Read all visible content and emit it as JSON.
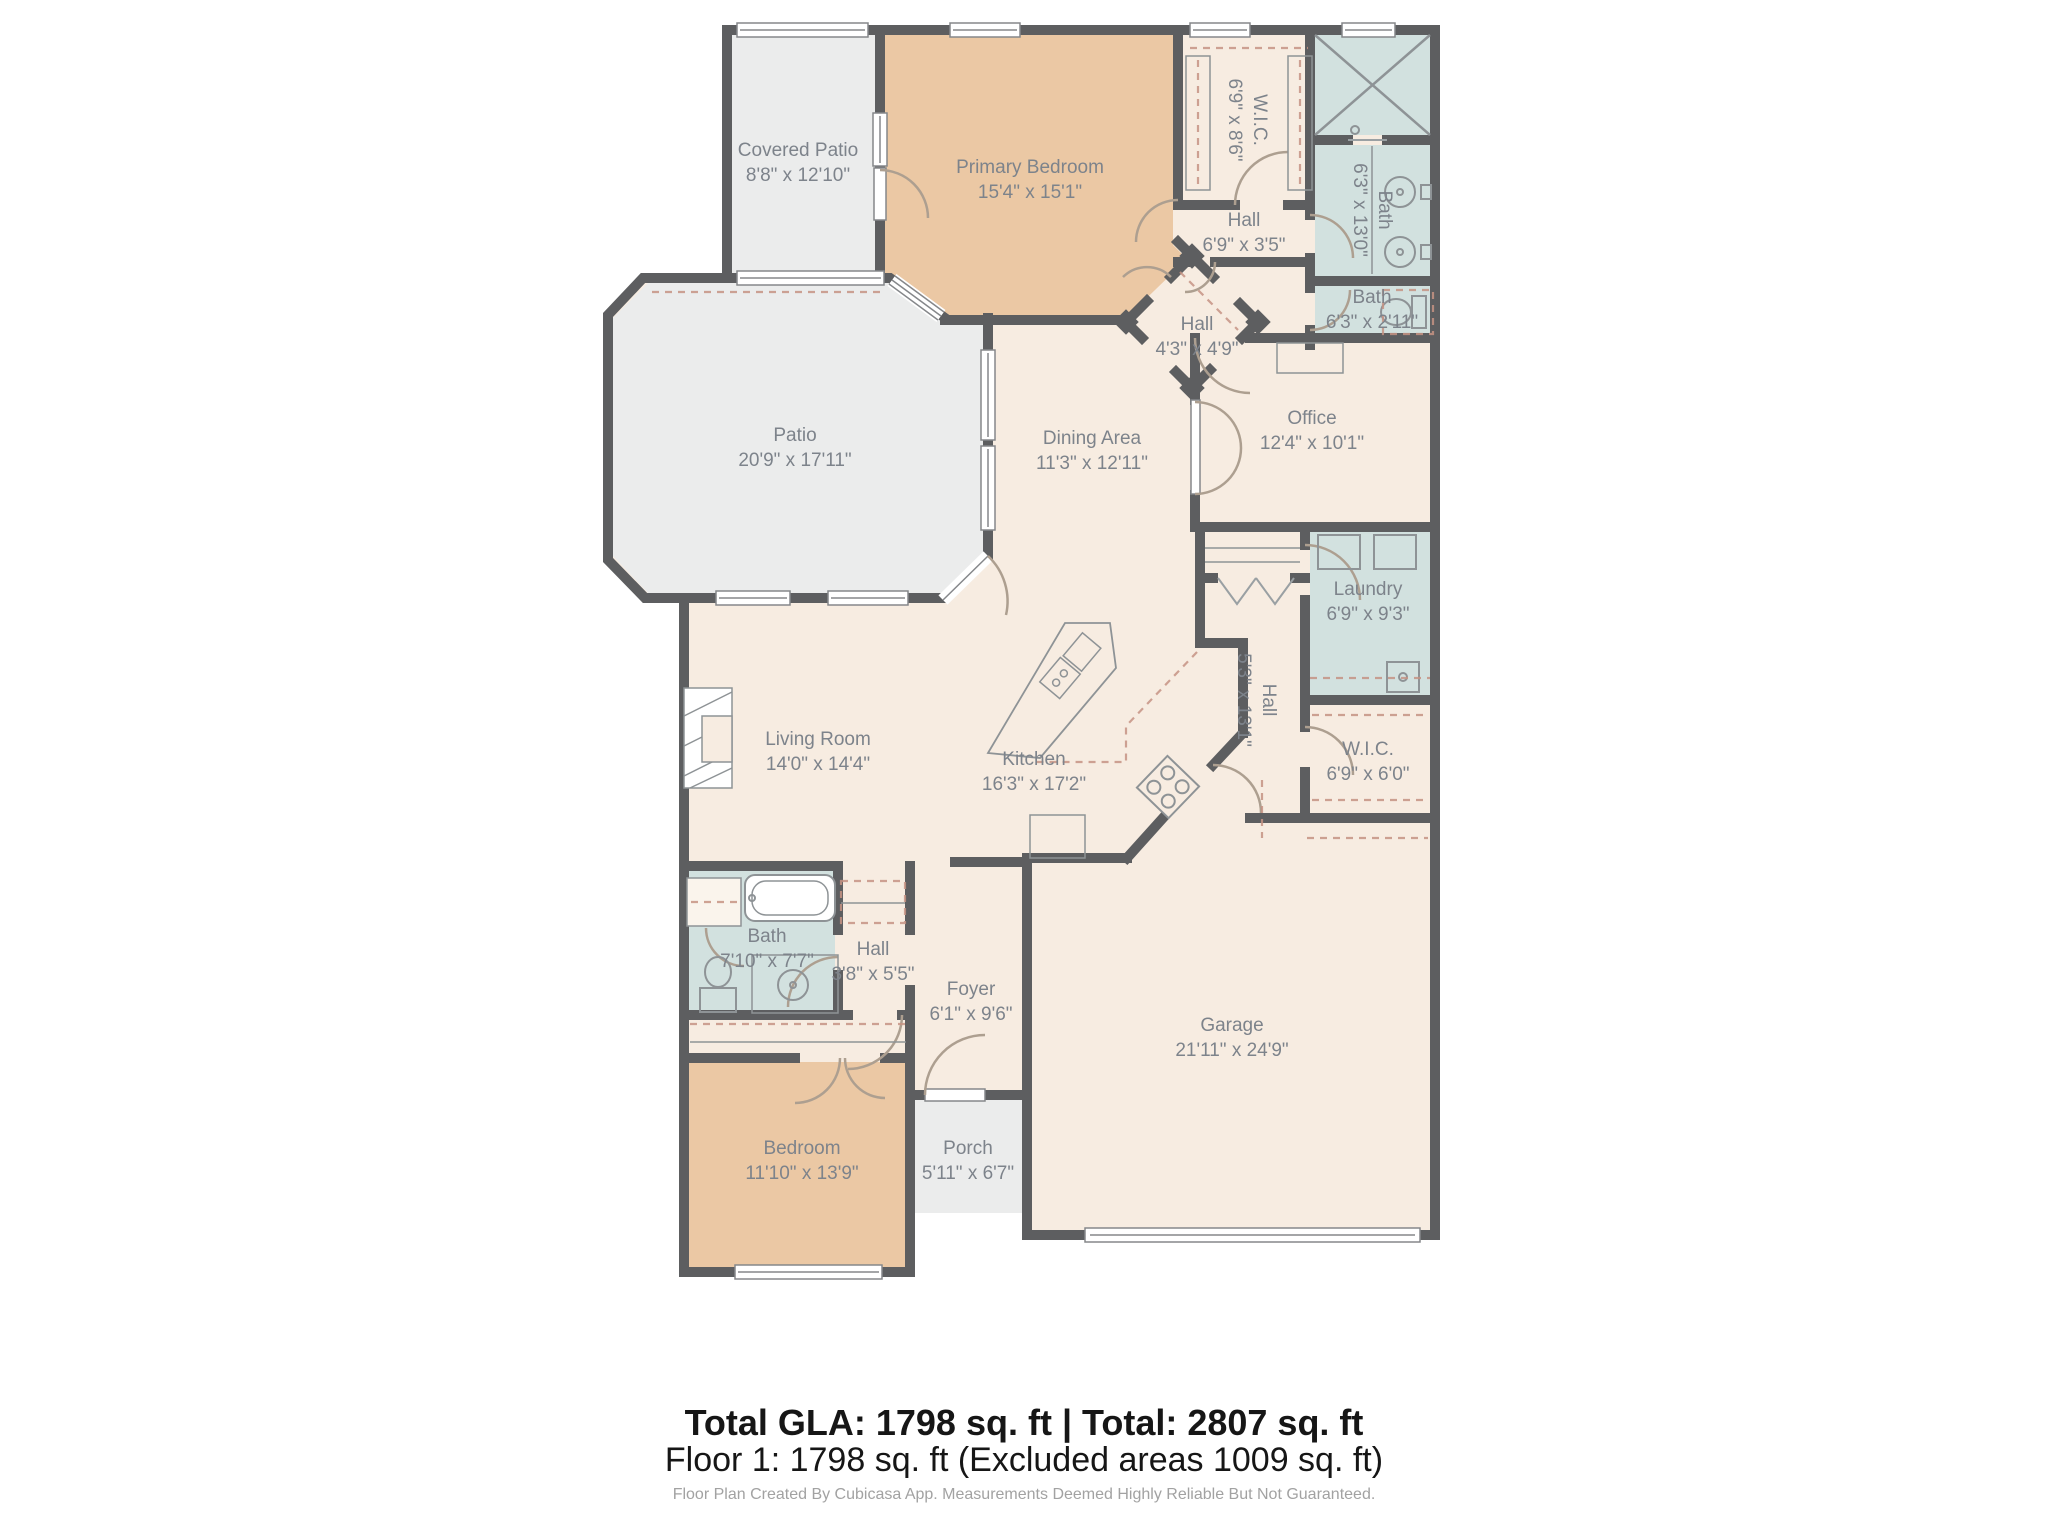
{
  "meta": {
    "app": "Cubicasa floor plan",
    "floor": "Floor 1"
  },
  "colors": {
    "wall": "#5d5e60",
    "floor": "#f7ece1",
    "bedroom_fill": "#ebc8a4",
    "wet_room_fill": "#d2e1df",
    "outdoor_fill": "#ebecec",
    "label_text": "#7d838b",
    "closet_dash": "#c59384"
  },
  "rooms": [
    {
      "name": "Covered Patio",
      "dims": "8'8\" x 12'10\""
    },
    {
      "name": "Primary Bedroom",
      "dims": "15'4\" x 15'1\""
    },
    {
      "name": "W.I.C.",
      "dims": "6'9\" x 8'6\""
    },
    {
      "name": "Bath",
      "dims": "6'3\" x 13'0\""
    },
    {
      "name": "Hall",
      "dims": "6'9\" x 3'5\""
    },
    {
      "name": "Bath",
      "dims": "6'3\" x 2'11\""
    },
    {
      "name": "Hall",
      "dims": "4'3\" x 4'9\""
    },
    {
      "name": "Patio",
      "dims": "20'9\" x 17'11\""
    },
    {
      "name": "Dining Area",
      "dims": "11'3\" x 12'11\""
    },
    {
      "name": "Office",
      "dims": "12'4\" x 10'1\""
    },
    {
      "name": "Laundry",
      "dims": "6'9\" x 9'3\""
    },
    {
      "name": "Hall",
      "dims": "5'3\" x 13'1\""
    },
    {
      "name": "W.I.C.",
      "dims": "6'9\" x 6'0\""
    },
    {
      "name": "Living Room",
      "dims": "14'0\" x 14'4\""
    },
    {
      "name": "Kitchen",
      "dims": "16'3\" x 17'2\""
    },
    {
      "name": "Bath",
      "dims": "7'10\" x 7'7\""
    },
    {
      "name": "Hall",
      "dims": "3'8\" x 5'5\""
    },
    {
      "name": "Foyer",
      "dims": "6'1\" x 9'6\""
    },
    {
      "name": "Bedroom",
      "dims": "11'10\" x 13'9\""
    },
    {
      "name": "Porch",
      "dims": "5'11\" x 6'7\""
    },
    {
      "name": "Garage",
      "dims": "21'11\" x 24'9\""
    }
  ],
  "footer": {
    "totals": "Total GLA: 1798 sq. ft | Total: 2807 sq. ft",
    "floor_line": "Floor 1: 1798 sq. ft (Excluded areas 1009 sq. ft)",
    "disclaimer": "Floor Plan Created By Cubicasa App. Measurements Deemed Highly Reliable But Not Guaranteed."
  }
}
